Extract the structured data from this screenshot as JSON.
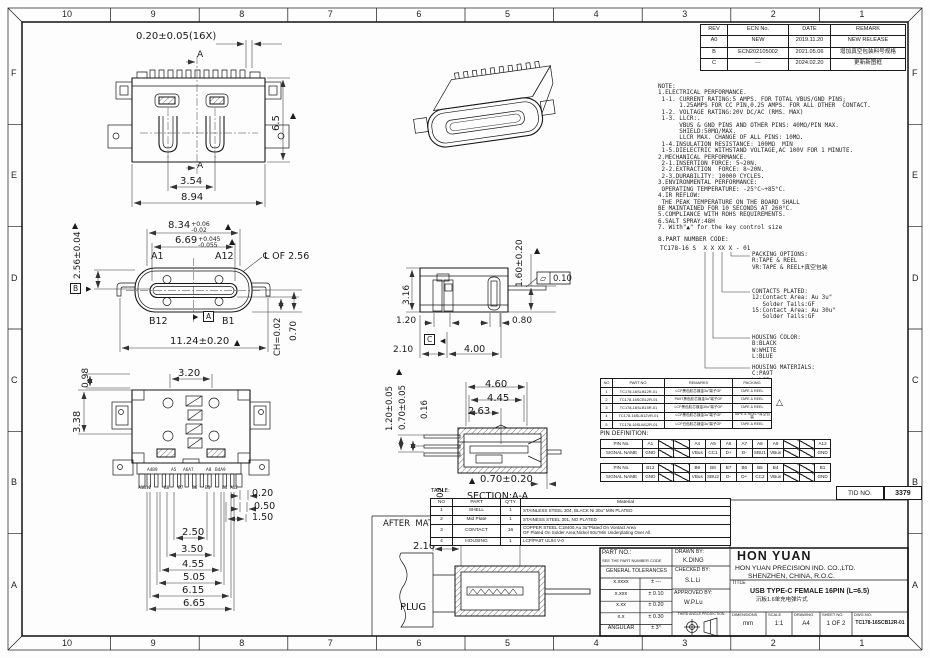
{
  "colors": {
    "line": "#1a1a1a",
    "paper": "#fdfdfd"
  },
  "border": {
    "top_numbers": [
      "10",
      "9",
      "8",
      "7",
      "6",
      "5",
      "4",
      "3",
      "2",
      "1"
    ],
    "bottom_numbers": [
      "10",
      "9",
      "8",
      "7",
      "6",
      "5",
      "4",
      "3",
      "2",
      "1"
    ],
    "left_letters": [
      "F",
      "E",
      "D",
      "C",
      "B",
      "A"
    ],
    "right_letters": [
      "F",
      "E",
      "D",
      "C",
      "B",
      "A"
    ]
  },
  "revision_table": {
    "headers": [
      "REV",
      "ECN No.",
      "DATE",
      "REMARK"
    ],
    "rows": [
      [
        "A0",
        "NEW",
        "2019.11.20",
        "NEW RELEASE"
      ],
      [
        "B",
        "ECN202105002",
        "2021.05.06",
        "增加真空包装料号规格"
      ],
      [
        "C",
        "---",
        "2024.02.20",
        "更新新图框"
      ]
    ]
  },
  "notes": {
    "lines": [
      "NOTE:",
      "1.ELECTRICAL PERFORMANCE.",
      " 1-1. CURRENT RATING:5 AMPS. FOR TOTAL VBUS/GND PINS;",
      "      1.25AMPS FOR CC PIN,0.25 AMPS. FOR ALL OTHER  CONTACT.",
      " 1-2. VOLTAGE RATING:20V DC/AC (RMS. MAX)",
      " 1-3. LLCR:.",
      "      VBUS & GND PINS AND OTHER PINS: 40MΩ/PIN MAX.",
      "      SHIELD:50MΩ/MAX.",
      "      LLCR MAX. CHANGE OF ALL PINS: 10MΩ.",
      " 1-4.INSULATION RESISTANCE: 100MΩ  MIN",
      " 1-5.DIELECTRIC WITHSTAND VOLTAGE,AC 100V FOR 1 MINUTE.",
      "2.MECHANICAL PERFORMANCE.",
      " 2-1.INSERTION FORCE: 5~20N.",
      " 2-2.EXTRACTION  FORCE: 8~20N.",
      " 2-3.DURABILITY: 10000 CYCLES.",
      "3.ENVIRONMENTAL PERFORMANCE:",
      " OPERATING TEMPERATURE: -25°C~+85°C.",
      "4.IR REFLOW:",
      " THE PEAK TEMPERATURE ON THE BOARD SHALL",
      "BE MAINTAINED FOR 10 SECONDS AT 260°C.",
      "5.COMPLIANCE WITH ROHS REQUIREMENTS.",
      "6.SALT SPRAY:48H",
      "7. With\"▲\" for the key control size"
    ]
  },
  "pn_code": {
    "heading": "8.PART NUMBER CODE:",
    "code": "TC178-16 S  X X XX X - 01",
    "branches": [
      {
        "id": "packing",
        "lines": [
          "PACKING OPTIONS:",
          "R:TAPE & REEL",
          "VR:TAPE & REEL+真空包装"
        ]
      },
      {
        "id": "contacts",
        "lines": [
          "CONTACTS PLATED:",
          "12:Contact Area: Au 3u\"",
          "   Solder Tails:GF",
          "15:Contact Area: Au 30u\"",
          "   Solder Tails:GF"
        ]
      },
      {
        "id": "color",
        "lines": [
          "HOUSING COLOR:",
          "B:BLACK",
          "W:WHITE",
          "L:BLUE"
        ]
      },
      {
        "id": "materials",
        "lines": [
          "HOUSING MATERIALS:",
          "C:PA9T",
          "L:LCP"
        ]
      }
    ]
  },
  "variant_table": {
    "headers": [
      "NO",
      "PART NO.",
      "REMARKS",
      "PACKING"
    ],
    "rows": [
      [
        "1",
        "TC178-16SLB12R-01",
        "LCP黑色胶芯镀金3u\"端子GF",
        "TAPE & REEL"
      ],
      [
        "2",
        "TC178-16SCB12R-01",
        "PA9T黑色胶芯镀金3u\"端子GF",
        "TAPE & REEL"
      ],
      [
        "3",
        "TC178-16SLB15R-01",
        "LCP黑色胶芯镀金30u\"端子GF",
        "TAPE & REEL"
      ],
      [
        "4",
        "TC178-16SLB12VR-01",
        "LCP黑色胶芯镀金3u\"端子GF",
        "TAPE & REEL+真空包装"
      ],
      [
        "5",
        "TC178-16SLW12R-01",
        "LCP白色胶芯镀金3u\"端子GF",
        "TAPE & REEL"
      ]
    ],
    "delta_mark": "△"
  },
  "pin_definition": {
    "title": "PIN DEFINITION:",
    "pin_label": "PIN No.",
    "signal_label": "SIGNAL NAME",
    "row_a": {
      "pins": [
        "A1",
        "",
        "",
        "A4",
        "A5",
        "A6",
        "A7",
        "A8",
        "A9",
        "",
        "",
        "A12"
      ],
      "signals": [
        "GND",
        "",
        "",
        "VBus",
        "CC1",
        "D+",
        "D-",
        "SBU1",
        "VBus",
        "",
        "",
        "GND"
      ]
    },
    "row_b": {
      "pins": [
        "B12",
        "",
        "",
        "B9",
        "B8",
        "B7",
        "B6",
        "B5",
        "B4",
        "",
        "",
        "B1"
      ],
      "signals": [
        "GND",
        "",
        "",
        "VBus",
        "SBU2",
        "D-",
        "D+",
        "CC2",
        "VBus",
        "",
        "",
        "GND"
      ]
    }
  },
  "tid": {
    "label": "TID NO.",
    "value": "3379"
  },
  "parts_table": {
    "title": "TABLE:",
    "headers": [
      "NO",
      "PART",
      "Q'TY",
      "Material"
    ],
    "rows": [
      [
        "1",
        "SHELL",
        "1",
        "STAINLESS STEEL 304, BLACK Ni 30u\" MIN PLATED"
      ],
      [
        "2",
        "Mid Plate",
        "1",
        "STAINESS STEEL 301, NO PLATED"
      ],
      [
        "3",
        "CONTACT",
        "16",
        "COPPER STEEL C18400,Au 3u\"Plated On Vontact Area\nGF Plated On Solder Area;Nickel 50u\"Min Underplating Over All."
      ],
      [
        "4",
        "HOUSING",
        "1",
        "LCP/PA9T UL94 V-0"
      ]
    ]
  },
  "title_block": {
    "part_no_label": "PART NO.:",
    "part_no_note": "SEE THE PART NUMBER CODE",
    "tol_header": "GENERAL TOLERANCES",
    "tolerances": [
      [
        "x.xxxx",
        "± ---"
      ],
      [
        "x.xxx",
        "± 0.10"
      ],
      [
        "x.xx",
        "± 0.20"
      ],
      [
        "x.x",
        "± 0.30"
      ],
      [
        "ANGULAR",
        "± 3°"
      ]
    ],
    "drawn_label": "DRAWN BY:",
    "drawn": "K.DING",
    "checked_label": "CHECKED BY:",
    "checked": "S.L.Li",
    "approved_label": "APPROVED BY:",
    "approved": "W.P.Lu",
    "projection_label": "THIRD ANGLE PROJECTION",
    "company": "HON YUAN",
    "company_line1": "HON YUAN PRECISION IND. CO.,LTD.",
    "company_line2": "SHENZHEN, CHINA, R.O.C.",
    "title_label": "TITLE",
    "title": "USB TYPE-C FEMALE 16PIN (L=6.5)",
    "subtitle": "沉板1.6单充电弹片式",
    "footer": [
      {
        "h": "DIMENSIONS",
        "v": "mm"
      },
      {
        "h": "SCALE",
        "v": "1:1"
      },
      {
        "h": "DRAWING",
        "v": "A4"
      },
      {
        "h": "SHEET NO.",
        "v": "1 OF 2"
      },
      {
        "h": "DWG.NO.",
        "v": "TC178-16SCB12R-01"
      }
    ]
  },
  "annotations": [
    {
      "t": "0.20±0.05(16X)",
      "x": 136,
      "y": 32,
      "s": 10
    },
    {
      "t": "A",
      "x": 197,
      "y": 51,
      "s": 9
    },
    {
      "t": "A",
      "x": 197,
      "y": 162,
      "s": 9
    },
    {
      "t": "6.5",
      "x": 272,
      "y": 131,
      "s": 10,
      "r": 1
    },
    {
      "t": "▲",
      "x": 290,
      "y": 112,
      "s": 8
    },
    {
      "t": "3.54",
      "x": 180,
      "y": 177,
      "s": 10
    },
    {
      "t": "8.94",
      "x": 181,
      "y": 193,
      "s": 10
    },
    {
      "t": "2.56±0.04",
      "x": 74,
      "y": 279,
      "s": 9,
      "r": 1
    },
    {
      "t": "▲",
      "x": 72,
      "y": 222,
      "s": 8
    },
    {
      "t": "8.34",
      "x": 168,
      "y": 221,
      "s": 10,
      "up": "+0.06",
      "dn": "-0.02"
    },
    {
      "t": "▲",
      "x": 225,
      "y": 223,
      "s": 8
    },
    {
      "t": "6.69",
      "x": 175,
      "y": 236,
      "s": 10,
      "up": "+0.045",
      "dn": "-0.055"
    },
    {
      "t": "▲",
      "x": 229,
      "y": 238,
      "s": 8
    },
    {
      "t": "A1",
      "x": 151,
      "y": 252,
      "s": 9.5
    },
    {
      "t": "A12",
      "x": 215,
      "y": 252,
      "s": 9.5
    },
    {
      "t": "℄ OF 2.56",
      "x": 263,
      "y": 252,
      "s": 9.5
    },
    {
      "t": "B12",
      "x": 149,
      "y": 317,
      "s": 9.5
    },
    {
      "t": "B1",
      "x": 222,
      "y": 317,
      "s": 9.5
    },
    {
      "t": "▶",
      "x": 193,
      "y": 314,
      "s": 7
    },
    {
      "t": "A",
      "x": 203,
      "y": 311,
      "s": 7.5,
      "box": 1
    },
    {
      "t": "B",
      "x": 70,
      "y": 283,
      "s": 7.5,
      "box": 1
    },
    {
      "t": "▶",
      "x": 86,
      "y": 286,
      "s": 7
    },
    {
      "t": "11.24±0.20",
      "x": 170,
      "y": 337,
      "s": 10
    },
    {
      "t": "▲",
      "x": 234,
      "y": 339,
      "s": 8
    },
    {
      "t": "CH=0.02",
      "x": 274,
      "y": 356,
      "s": 8.5,
      "r": 1
    },
    {
      "t": "0.70",
      "x": 290,
      "y": 341,
      "s": 9,
      "r": 1
    },
    {
      "t": "0.98",
      "x": 82,
      "y": 388,
      "s": 9,
      "r": 1
    },
    {
      "t": "3.20",
      "x": 178,
      "y": 369,
      "s": 10
    },
    {
      "t": "3.38",
      "x": 73,
      "y": 433,
      "s": 10,
      "r": 1
    },
    {
      "t": "A4B9",
      "x": 147,
      "y": 468,
      "s": 4
    },
    {
      "t": "A5",
      "x": 171,
      "y": 468,
      "s": 4
    },
    {
      "t": "A6A7",
      "x": 183,
      "y": 468,
      "s": 4
    },
    {
      "t": "A8",
      "x": 206,
      "y": 468,
      "s": 4
    },
    {
      "t": "B4A9",
      "x": 215,
      "y": 468,
      "s": 4
    },
    {
      "t": "A1B12",
      "x": 138,
      "y": 486,
      "s": 4
    },
    {
      "t": "B8",
      "x": 164,
      "y": 486,
      "s": 4
    },
    {
      "t": "B7",
      "x": 178,
      "y": 486,
      "s": 4
    },
    {
      "t": "B6",
      "x": 192,
      "y": 486,
      "s": 4
    },
    {
      "t": "B5",
      "x": 205,
      "y": 486,
      "s": 4
    },
    {
      "t": "B1",
      "x": 222,
      "y": 486,
      "s": 4
    },
    {
      "t": "A12",
      "x": 230,
      "y": 486,
      "s": 4
    },
    {
      "t": "0.20",
      "x": 252,
      "y": 489,
      "s": 9.5
    },
    {
      "t": "0.50",
      "x": 254,
      "y": 502,
      "s": 9.5
    },
    {
      "t": "1.50",
      "x": 252,
      "y": 513,
      "s": 9.5
    },
    {
      "t": "2.50",
      "x": 182,
      "y": 528,
      "s": 10
    },
    {
      "t": "3.50",
      "x": 181,
      "y": 545,
      "s": 10
    },
    {
      "t": "4.55",
      "x": 182,
      "y": 560,
      "s": 10
    },
    {
      "t": "5.05",
      "x": 183,
      "y": 573,
      "s": 10
    },
    {
      "t": "6.15",
      "x": 182,
      "y": 586,
      "s": 10
    },
    {
      "t": "6.65",
      "x": 183,
      "y": 599,
      "s": 10
    },
    {
      "t": "3.16",
      "x": 403,
      "y": 305,
      "s": 9,
      "r": 1
    },
    {
      "t": "1.60±0.20",
      "x": 516,
      "y": 287,
      "s": 9,
      "r": 1
    },
    {
      "t": "▲",
      "x": 534,
      "y": 247,
      "s": 8
    },
    {
      "t": "▱",
      "x": 540,
      "y": 275,
      "s": 8
    },
    {
      "t": "0.10",
      "x": 553,
      "y": 275,
      "s": 8.5
    },
    {
      "t": "1.20",
      "x": 396,
      "y": 317,
      "s": 9
    },
    {
      "t": "0.80",
      "x": 512,
      "y": 317,
      "s": 9
    },
    {
      "t": "C",
      "x": 424,
      "y": 334,
      "s": 7.5,
      "box": 1
    },
    {
      "t": "◀",
      "x": 440,
      "y": 338,
      "s": 7
    },
    {
      "t": "2.10",
      "x": 393,
      "y": 346,
      "s": 9
    },
    {
      "t": "4.00",
      "x": 464,
      "y": 345,
      "s": 9.5
    },
    {
      "t": "▲",
      "x": 396,
      "y": 368,
      "s": 8
    },
    {
      "t": "1.20±0.05",
      "x": 386,
      "y": 431,
      "s": 8.5,
      "r": 1
    },
    {
      "t": "0.70±0.05",
      "x": 399,
      "y": 430,
      "s": 8.5,
      "r": 1
    },
    {
      "t": "0.16",
      "x": 421,
      "y": 419,
      "s": 8.5,
      "r": 1
    },
    {
      "t": "4.60",
      "x": 485,
      "y": 380,
      "s": 10
    },
    {
      "t": "4.45",
      "x": 487,
      "y": 394,
      "s": 10
    },
    {
      "t": "2.63",
      "x": 468,
      "y": 407,
      "s": 10
    },
    {
      "t": "▲",
      "x": 469,
      "y": 477,
      "s": 8
    },
    {
      "t": "0.70±0.20",
      "x": 480,
      "y": 475,
      "s": 10
    },
    {
      "t": "0.02",
      "x": 437,
      "y": 506,
      "s": 8.5,
      "r": 1
    },
    {
      "t": "SECTION:A-A",
      "x": 467,
      "y": 492,
      "s": 9.5,
      "u": 1
    },
    {
      "t": "AFTER  MATING",
      "x": 383,
      "y": 520,
      "s": 8.5
    },
    {
      "t": "6.65",
      "x": 464,
      "y": 529,
      "s": 10
    },
    {
      "t": "2.10",
      "x": 413,
      "y": 542,
      "s": 10
    },
    {
      "t": "PLUG",
      "x": 400,
      "y": 603,
      "s": 10
    },
    {
      "t": "△",
      "x": 776,
      "y": 399,
      "s": 9
    }
  ]
}
